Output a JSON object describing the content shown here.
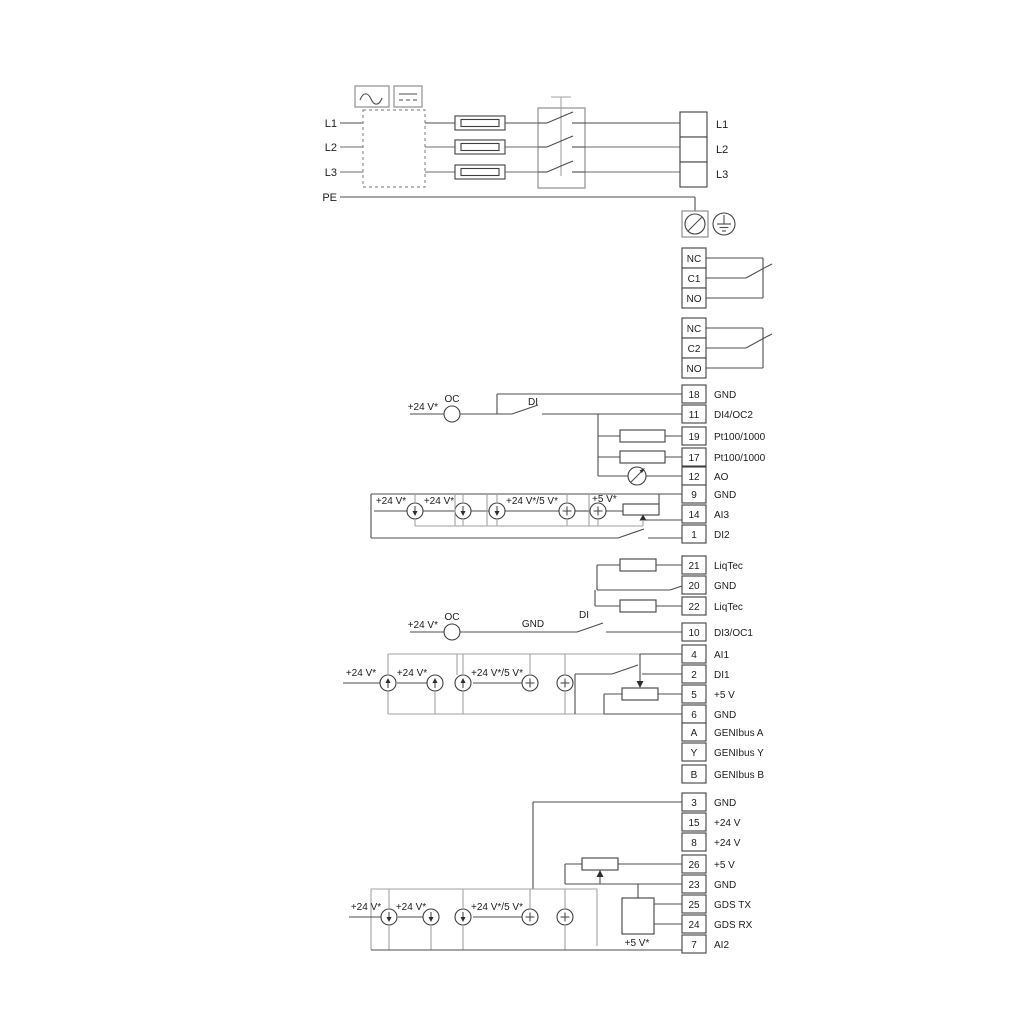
{
  "power": {
    "left": [
      "L1",
      "L2",
      "L3",
      "PE"
    ],
    "right": [
      "L1",
      "L2",
      "L3"
    ]
  },
  "relays": [
    {
      "cells": [
        "NC",
        "C1",
        "NO"
      ]
    },
    {
      "cells": [
        "NC",
        "C2",
        "NO"
      ]
    }
  ],
  "terminal_groups": {
    "io1": [
      {
        "n": "18",
        "t": "GND"
      },
      {
        "n": "11",
        "t": "DI4/OC2"
      },
      {
        "n": "19",
        "t": "Pt100/1000"
      },
      {
        "n": "17",
        "t": "Pt100/1000"
      },
      {
        "n": "12",
        "t": "AO"
      },
      {
        "n": "9",
        "t": "GND"
      },
      {
        "n": "14",
        "t": "AI3"
      },
      {
        "n": "1",
        "t": "DI2"
      }
    ],
    "liqtec": [
      {
        "n": "21",
        "t": "LiqTec"
      },
      {
        "n": "20",
        "t": "GND"
      },
      {
        "n": "22",
        "t": "LiqTec"
      }
    ],
    "io2": [
      {
        "n": "10",
        "t": "DI3/OC1"
      },
      {
        "n": "4",
        "t": "AI1"
      },
      {
        "n": "2",
        "t": "DI1"
      },
      {
        "n": "5",
        "t": "+5 V"
      },
      {
        "n": "6",
        "t": "GND"
      },
      {
        "n": "A",
        "t": "GENIbus A"
      },
      {
        "n": "Y",
        "t": "GENIbus Y"
      },
      {
        "n": "B",
        "t": "GENIbus B"
      }
    ],
    "io3": [
      {
        "n": "3",
        "t": "GND"
      },
      {
        "n": "15",
        "t": "+24 V"
      },
      {
        "n": "8",
        "t": "+24 V"
      },
      {
        "n": "26",
        "t": "+5 V"
      },
      {
        "n": "23",
        "t": "GND"
      },
      {
        "n": "25",
        "t": "GDS TX"
      },
      {
        "n": "24",
        "t": "GDS RX"
      },
      {
        "n": "7",
        "t": "AI2"
      }
    ]
  },
  "labels": {
    "v24": "+24 V*",
    "combo": "+24 V*/5 V*",
    "v5": "+5 V*",
    "oc": "OC",
    "di": "DI",
    "gnd": "GND"
  },
  "colors": {
    "wire": "#4d4d4d",
    "bracket": "#a3a3a3",
    "background": "#ffffff"
  }
}
